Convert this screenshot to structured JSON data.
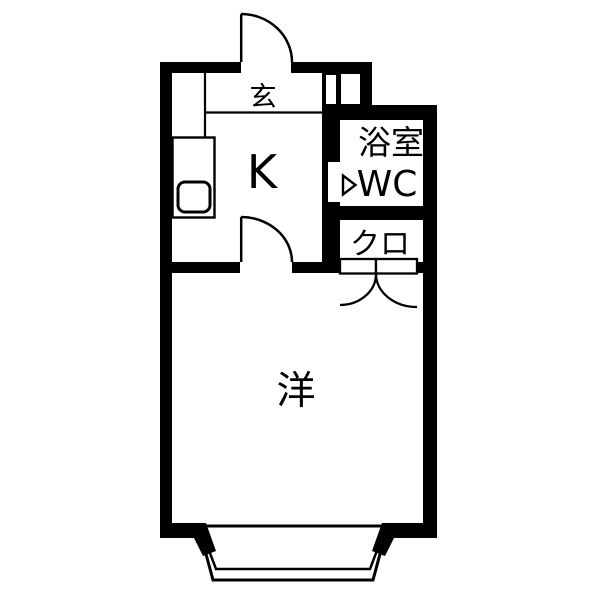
{
  "floorplan": {
    "background": "#ffffff",
    "line_color": "#000000",
    "rooms": {
      "entrance": {
        "label": "玄"
      },
      "kitchen": {
        "label": "K"
      },
      "bath": {
        "label": "浴室",
        "label2": "WC"
      },
      "closet": {
        "label": "クロ"
      },
      "main_room": {
        "label": "洋"
      }
    }
  }
}
